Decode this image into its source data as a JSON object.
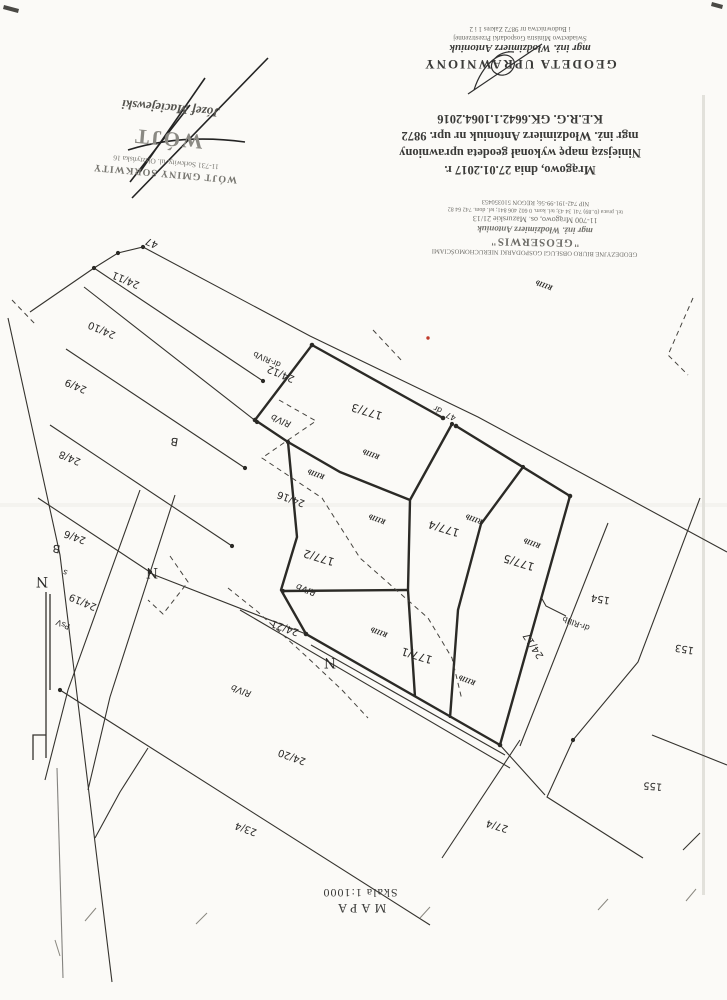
{
  "document": {
    "certificate": {
      "title": "GEODETA UPRAWNIONY",
      "name": "mgr inż. Włodzimierz Antoniuk",
      "small_lines": [
        "Świadectwo Ministra Gospodarki Przestrzennej",
        "i Budownictwa nr 9872 Zakres 1 i 2"
      ]
    },
    "statement": {
      "lines": [
        "Mrągowo, dnia 27.01.2017 r.",
        "Niniejszą mapę wykonał geodeta uprawniony",
        "mgr inż. Włodzimierz Antoniuk nr upr. 9872",
        "K.E.R.G. GK.6642.1.1064.2016"
      ]
    },
    "geoserwis_stamp": {
      "line1": "GEODEZYJNE BIURO OBSŁUGI GOSPODARKI NIERUCHOMOŚCIAMI",
      "title": "\"GEOSERWIS\"",
      "name": "mgr inż. Włodzimierz Antoniuk",
      "address": "11-700 Mrągowo, os. Mazurskie 21/13",
      "phones": "tel. praca (0..89) 741 34 43; tel. kom. 0 602 406 841; tel. dom. 742 64 82",
      "nip": "NIP 742-191-99-56; REGON 510350453"
    },
    "wojt_stamp": {
      "office": "WÓJT GMINY SORKWITY",
      "address": "11-731 Sorkwity, ul. Olsztyńska 16",
      "big": "WÓJT",
      "signature": "Józef Maciejewski"
    },
    "footer": {
      "map_label": "MAPA",
      "scale_label": "Skala 1:1000"
    }
  },
  "map": {
    "ink_color": "#35332e",
    "bold_color": "#2b2a26",
    "red_point_color": "#c03a2b",
    "labels": [
      {
        "t": "47",
        "x": 153,
        "y": 240,
        "r": 203,
        "c": "p"
      },
      {
        "t": "24/11",
        "x": 127,
        "y": 277,
        "r": 203,
        "c": "p"
      },
      {
        "t": "24/10",
        "x": 103,
        "y": 327,
        "r": 203,
        "c": "p"
      },
      {
        "t": "24/9",
        "x": 77,
        "y": 383,
        "r": 203,
        "c": "p"
      },
      {
        "t": "24/8",
        "x": 71,
        "y": 455,
        "r": 203,
        "c": "p"
      },
      {
        "t": "24/6",
        "x": 76,
        "y": 534,
        "r": 200,
        "c": "p"
      },
      {
        "t": "24/19",
        "x": 84,
        "y": 599,
        "r": 203,
        "c": "p"
      },
      {
        "t": "24/12",
        "x": 282,
        "y": 371,
        "r": 203,
        "c": "p"
      },
      {
        "t": "24/16",
        "x": 292,
        "y": 496,
        "r": 200,
        "c": "p"
      },
      {
        "t": "24/21",
        "x": 286,
        "y": 625,
        "r": 200,
        "c": "p"
      },
      {
        "t": "24/20",
        "x": 293,
        "y": 754,
        "r": 200,
        "c": "p"
      },
      {
        "t": "23/4",
        "x": 247,
        "y": 826,
        "r": 200,
        "c": "p"
      },
      {
        "t": "27/4",
        "x": 498,
        "y": 823,
        "r": 197,
        "c": "p"
      },
      {
        "t": "177/3",
        "x": 368,
        "y": 408,
        "r": 197,
        "c": "P"
      },
      {
        "t": "177/2",
        "x": 320,
        "y": 554,
        "r": 197,
        "c": "P"
      },
      {
        "t": "177/1",
        "x": 418,
        "y": 652,
        "r": 197,
        "c": "P"
      },
      {
        "t": "177/4",
        "x": 445,
        "y": 525,
        "r": 197,
        "c": "P"
      },
      {
        "t": "177/5",
        "x": 520,
        "y": 559,
        "r": 197,
        "c": "P"
      },
      {
        "t": "24/17",
        "x": 536,
        "y": 644,
        "r": 237,
        "c": "p"
      },
      {
        "t": "154",
        "x": 601,
        "y": 596,
        "r": 190,
        "c": "p"
      },
      {
        "t": "153",
        "x": 685,
        "y": 646,
        "r": 190,
        "c": "p"
      },
      {
        "t": "155",
        "x": 653,
        "y": 783,
        "r": 185,
        "c": "p"
      },
      {
        "t": "RIIIb",
        "x": 545,
        "y": 283,
        "r": 200,
        "c": "s"
      },
      {
        "t": "RIIIb",
        "x": 372,
        "y": 452,
        "r": 200,
        "c": "s"
      },
      {
        "t": "RIIIb",
        "x": 317,
        "y": 472,
        "r": 200,
        "c": "s"
      },
      {
        "t": "RIIIb",
        "x": 378,
        "y": 517,
        "r": 200,
        "c": "s"
      },
      {
        "t": "RIIIb",
        "x": 475,
        "y": 517,
        "r": 200,
        "c": "s"
      },
      {
        "t": "RIIIb",
        "x": 533,
        "y": 541,
        "r": 200,
        "c": "s"
      },
      {
        "t": "RIIIb",
        "x": 380,
        "y": 630,
        "r": 200,
        "c": "s"
      },
      {
        "t": "RIIIb",
        "x": 468,
        "y": 678,
        "r": 200,
        "c": "s"
      },
      {
        "t": "RIVb",
        "x": 282,
        "y": 418,
        "r": 203,
        "c": "v"
      },
      {
        "t": "RIVb",
        "x": 307,
        "y": 587,
        "r": 200,
        "c": "v"
      },
      {
        "t": "RIVb",
        "x": 242,
        "y": 688,
        "r": 200,
        "c": "v"
      },
      {
        "t": "dr-RIVb",
        "x": 268,
        "y": 357,
        "r": 203,
        "c": "d"
      },
      {
        "t": "dr-RIIIb",
        "x": 577,
        "y": 621,
        "r": 200,
        "c": "d"
      },
      {
        "t": "PsV",
        "x": 64,
        "y": 622,
        "r": 203,
        "c": "d"
      },
      {
        "t": "dr",
        "x": 439,
        "y": 407,
        "r": 205,
        "c": "d"
      },
      {
        "t": "47",
        "x": 452,
        "y": 414,
        "r": 205,
        "c": "d"
      },
      {
        "t": "s",
        "x": 66,
        "y": 570,
        "r": 200,
        "c": "d"
      },
      {
        "t": "B",
        "x": 175,
        "y": 438,
        "r": 190,
        "c": "B"
      },
      {
        "t": "B",
        "x": 57,
        "y": 545,
        "r": 190,
        "c": "B"
      },
      {
        "t": "N",
        "x": 152,
        "y": 568,
        "r": 180,
        "c": "N"
      },
      {
        "t": "N",
        "x": 330,
        "y": 658,
        "r": 180,
        "c": "N"
      },
      {
        "t": "N",
        "x": 42,
        "y": 577,
        "r": 180,
        "c": "N"
      }
    ]
  }
}
